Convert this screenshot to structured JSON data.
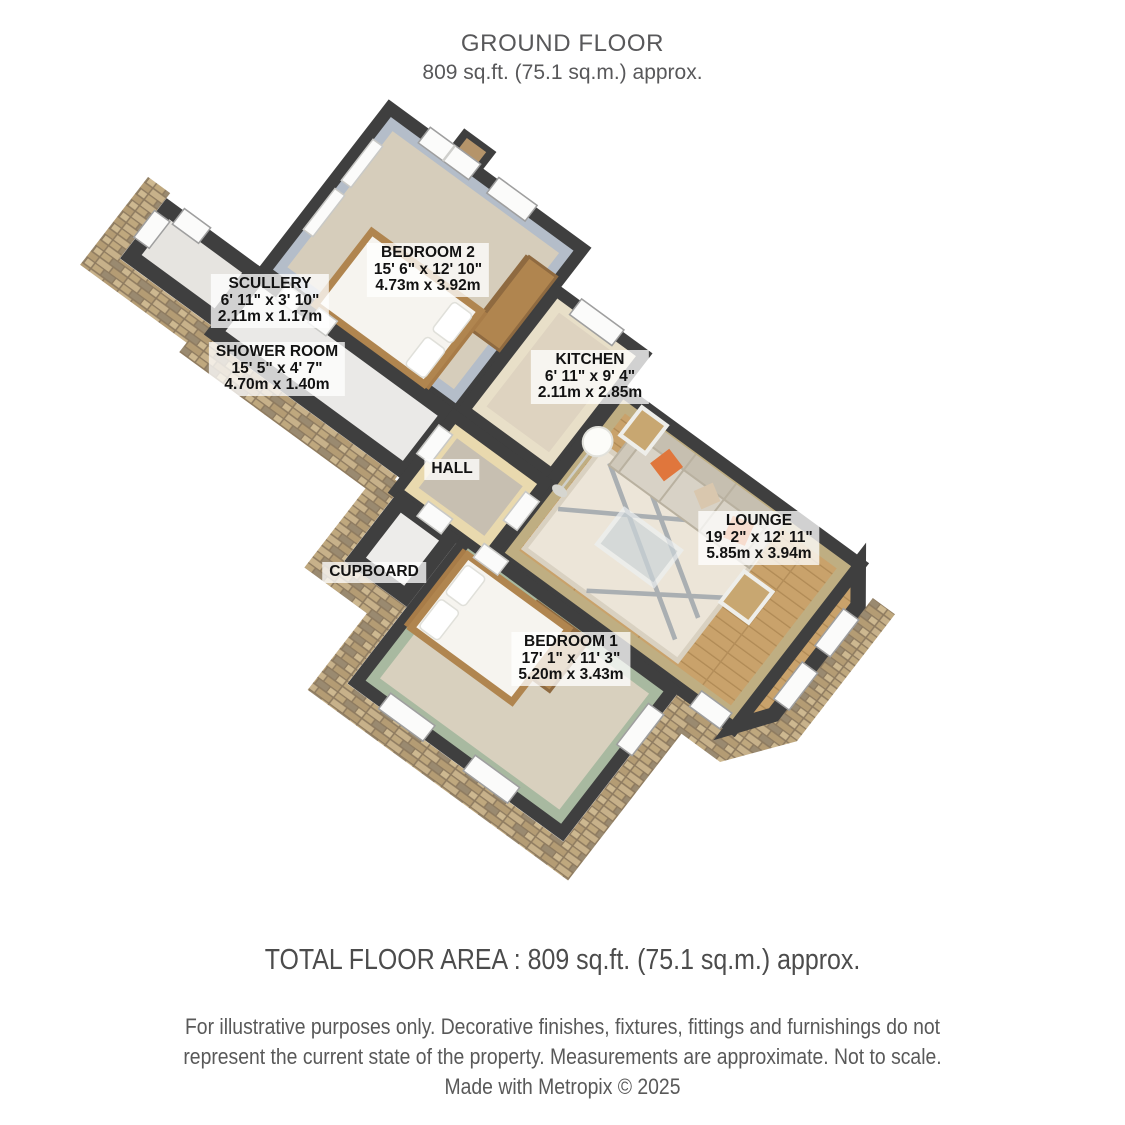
{
  "header": {
    "title": "GROUND FLOOR",
    "subtitle": "809 sq.ft. (75.1 sq.m.) approx."
  },
  "rooms": [
    {
      "name": "SCULLERY",
      "dims_imperial": "6' 11\" x 3' 10\"",
      "dims_metric": "2.11m x 1.17m"
    },
    {
      "name": "SHOWER ROOM",
      "dims_imperial": "15' 5\" x 4' 7\"",
      "dims_metric": "4.70m x 1.40m"
    },
    {
      "name": "BEDROOM 2",
      "dims_imperial": "15' 6\" x 12' 10\"",
      "dims_metric": "4.73m x 3.92m"
    },
    {
      "name": "KITCHEN",
      "dims_imperial": "6' 11\" x 9' 4\"",
      "dims_metric": "2.11m x 2.85m"
    },
    {
      "name": "HALL"
    },
    {
      "name": "CUPBOARD"
    },
    {
      "name": "BEDROOM 1",
      "dims_imperial": "17' 1\" x 11' 3\"",
      "dims_metric": "5.20m x 3.43m"
    },
    {
      "name": "LOUNGE",
      "dims_imperial": "19' 2\" x 12' 11\"",
      "dims_metric": "5.85m x 3.94m"
    }
  ],
  "footer": {
    "total_area": "TOTAL FLOOR AREA : 809 sq.ft. (75.1 sq.m.) approx.",
    "disclaimer_line1": "For illustrative purposes only. Decorative finishes, fixtures, fittings and furnishings do not",
    "disclaimer_line2": "represent the current state of the property. Measurements are approximate. Not to scale.",
    "disclaimer_line3": "Made with Metropix © 2025"
  },
  "colors": {
    "wall_cap": "#3f3f3f",
    "stone": "#b49c74",
    "wood_floor": "#c9a26b",
    "carpet_beige": "#d6cdbb",
    "bedroom1_wall_green": "#a8b9a0",
    "bedroom2_wall_blue": "#b4bdc9",
    "lounge_wall_khaki": "#bfae82",
    "sofa_pillow_orange": "#e0763c"
  }
}
